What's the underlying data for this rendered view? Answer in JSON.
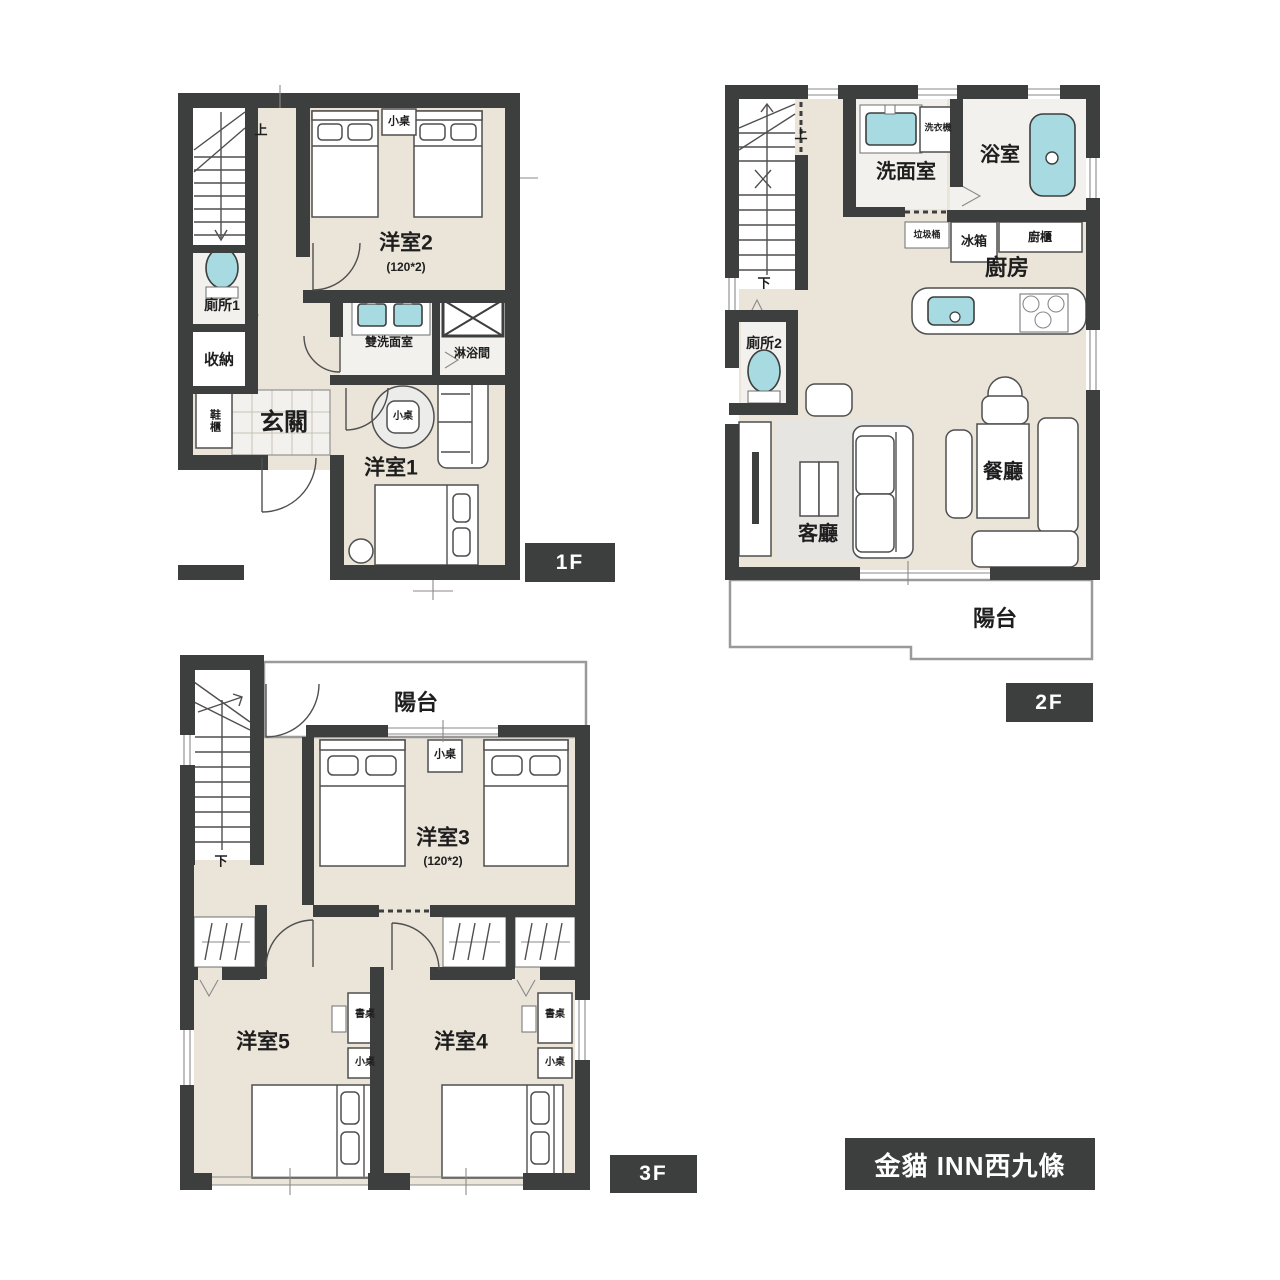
{
  "title": "金貓 INN西九條",
  "floor1": {
    "tag": "1F",
    "stairs_up": "上",
    "small_table_beds": "小桌",
    "room2": "洋室2",
    "room2_size": "(120*2)",
    "toilet1": "廁所1",
    "storage": "收納",
    "shoe_cabinet": "鞋櫃",
    "entrance": "玄關",
    "double_washroom": "雙洗面室",
    "shower_room": "淋浴間",
    "small_table_round": "小桌",
    "room1": "洋室1"
  },
  "floor2": {
    "tag": "2F",
    "stairs_up": "上",
    "stairs_down": "下",
    "washroom": "洗面室",
    "washing_machine": "洗衣機",
    "bathroom": "浴室",
    "trash_bin": "垃圾桶",
    "fridge": "冰箱",
    "kitchen_cabinet": "廚櫃",
    "kitchen": "廚房",
    "toilet2": "廁所2",
    "living_room": "客廳",
    "dining_room": "餐廳",
    "balcony": "陽台"
  },
  "floor3": {
    "tag": "3F",
    "balcony": "陽台",
    "stairs_down": "下",
    "small_table_beds": "小桌",
    "room3": "洋室3",
    "room3_size": "(120*2)",
    "room5": "洋室5",
    "desk5": "書桌",
    "small_table5": "小桌",
    "room4": "洋室4",
    "desk4": "書桌",
    "small_table4": "小桌"
  },
  "colors": {
    "wall": "#3d3e3e",
    "floor": "#eae4d9",
    "wet_floor": "#f2f1ed",
    "fixture": "#a7dbe1",
    "rug": "#e6e5e2"
  }
}
